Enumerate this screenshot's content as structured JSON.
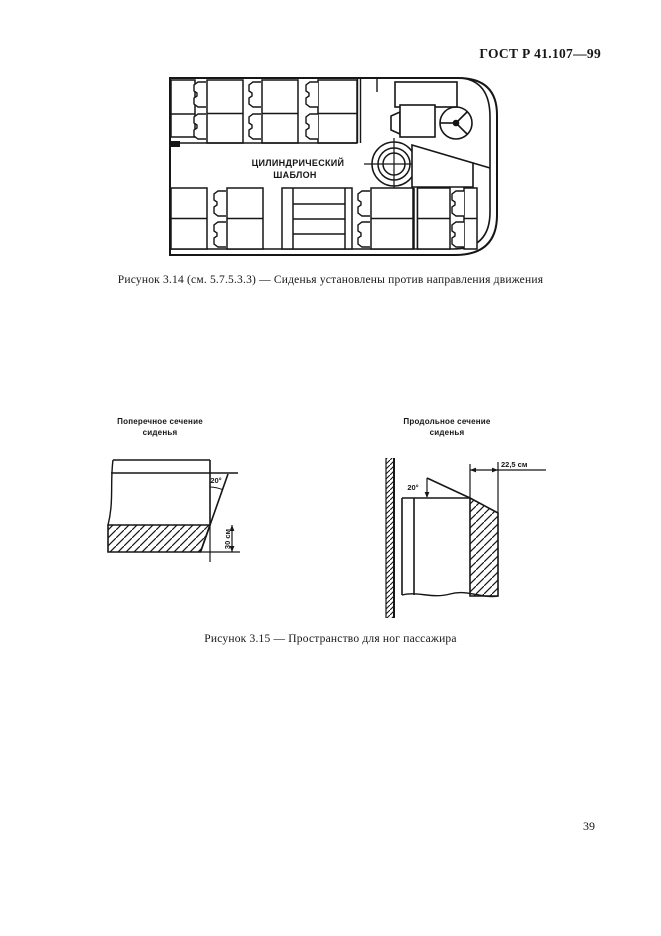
{
  "page": {
    "number": "39"
  },
  "header": {
    "standard_code": "ГОСТ Р 41.107—99"
  },
  "figure_3_14": {
    "template_label_line1": "ЦИЛИНДРИЧЕСКИЙ",
    "template_label_line2": "ШАБЛОН",
    "caption": "Рисунок 3.14 (см. 5.7.5.3.3) — Сиденья установлены против направления движения"
  },
  "figure_3_15": {
    "left_section": {
      "title_line1": "Поперечное сечение",
      "title_line2": "сиденья",
      "angle": "20°",
      "height_dim": "30 см"
    },
    "right_section": {
      "title_line1": "Продольное сечение",
      "title_line2": "сиденья",
      "angle": "20°",
      "depth_dim": "22,5 см"
    },
    "caption": "Рисунок 3.15 — Пространство для ног пассажира"
  },
  "colors": {
    "ink": "#161616",
    "paper": "#ffffff"
  }
}
